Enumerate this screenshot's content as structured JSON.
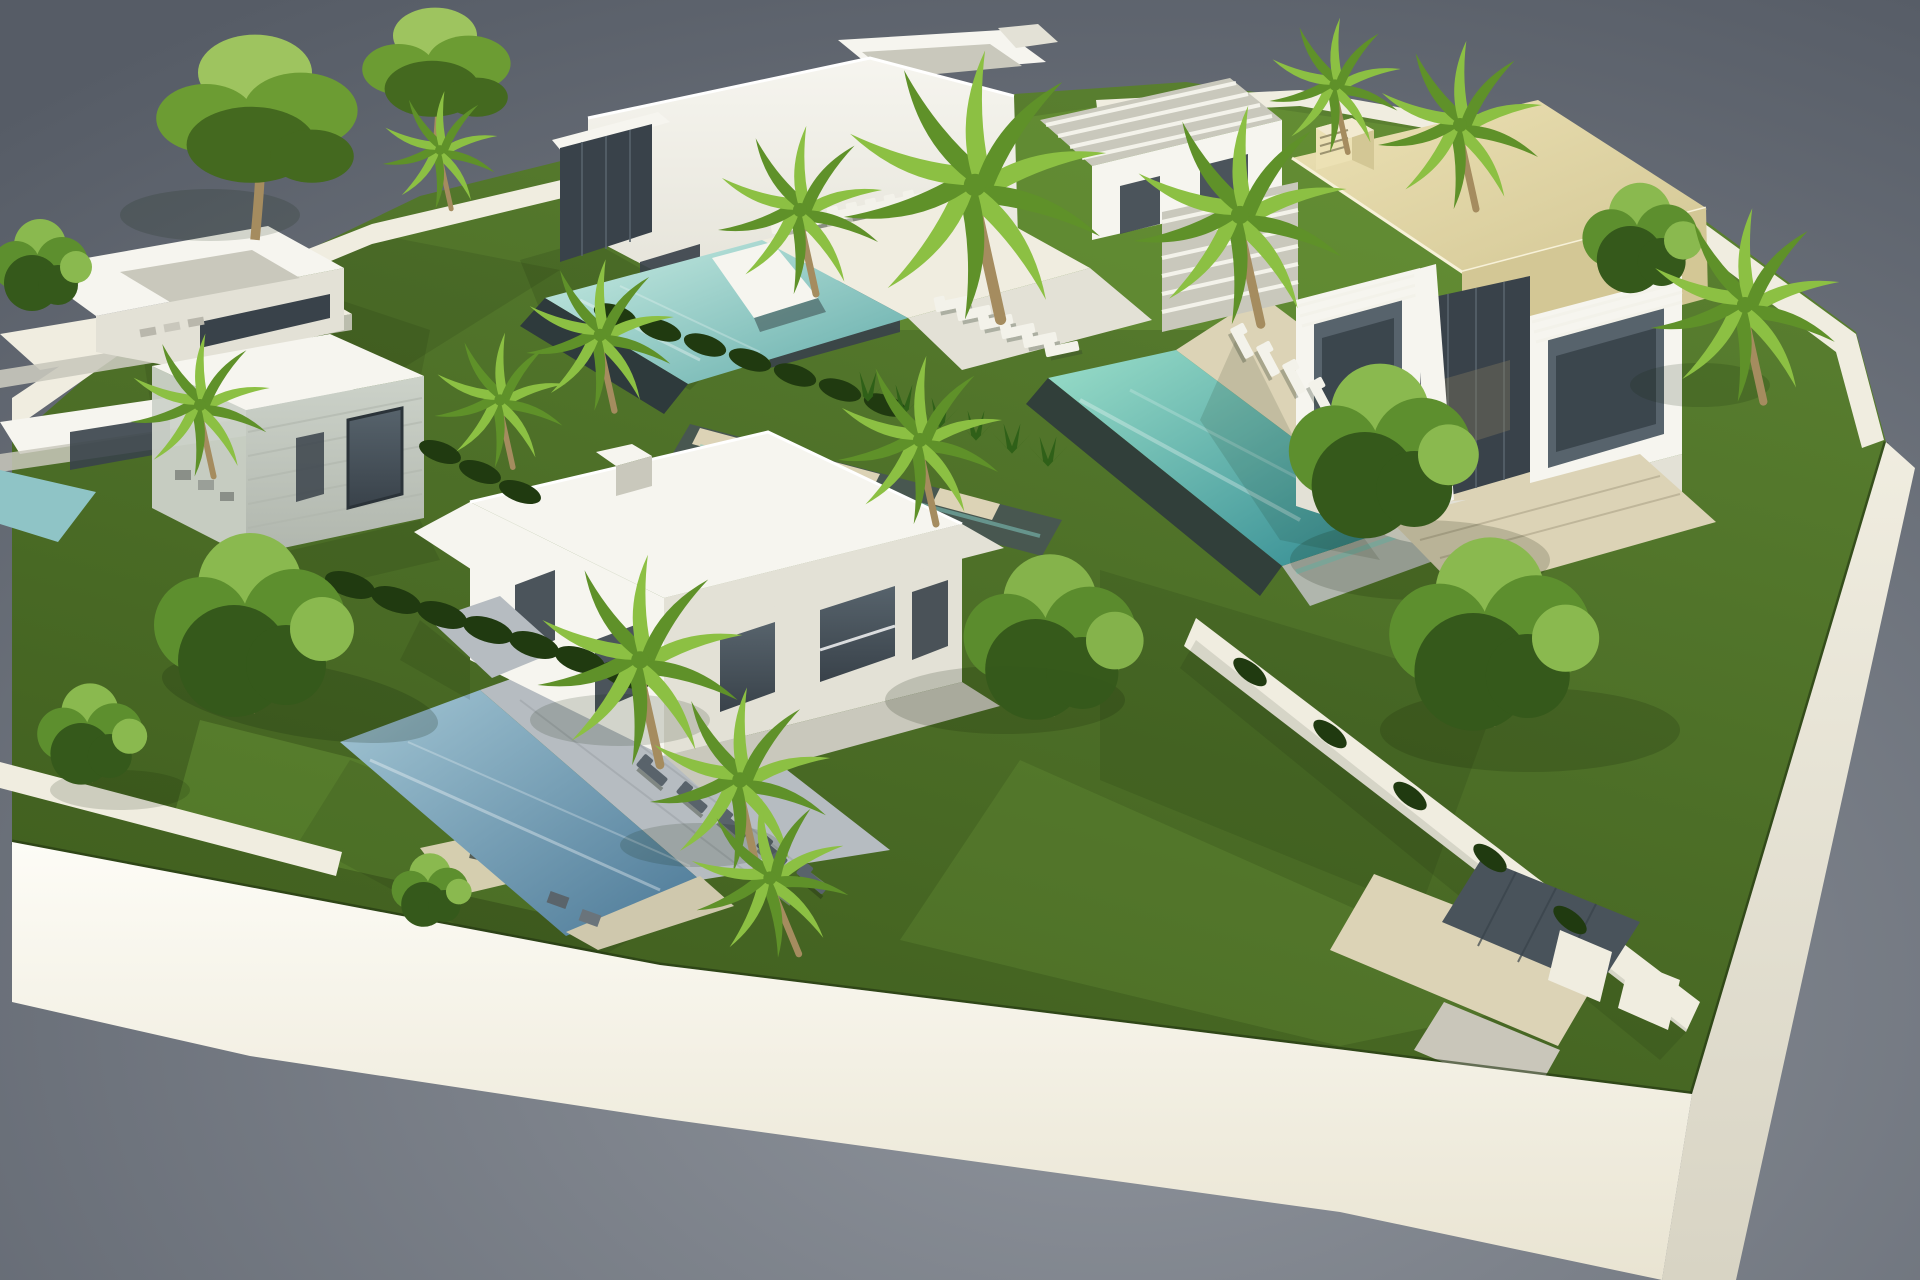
{
  "scene": {
    "description": "Aerial 3D architectural rendering of a walled luxury villa development: five modern white villas with private pools, green lawns, palm trees and a bright white perimeter wall, floating on a grey studio background.",
    "type": "architectural-visualization",
    "villas": [
      "left flat-roof white villa",
      "stone-clad guest villa",
      "top-centre villa with infinity pool and roof terrace",
      "beige-roof villa with long pool",
      "bottom-centre two-storey villa with lap pool"
    ],
    "pools": [
      "infinity pool (top centre)",
      "long pool (right)",
      "lap pool (bottom centre)",
      "corner plunge pool (left edge)"
    ],
    "tree_count": 25,
    "sun_lounger_count": 27
  },
  "palette": {
    "bg_center": "#90959d",
    "bg_edge": "#565c66",
    "wall_top": "#fdfcf6",
    "wall_bottom": "#e9e4d2",
    "wall_side_top": "#f0ede0",
    "wall_side_bottom": "#d8d4c4",
    "lawn_a": "#5a8030",
    "lawn_b": "#3f5d1e",
    "lawn_light": "#6f9d3a",
    "shadow": "rgba(15,30,8,0.38)",
    "pool_top_pale": "#c9ece3",
    "pool_top_deep": "#63acaa",
    "pool_right_pale": "#9adec9",
    "pool_right_deep": "#2f8890",
    "pool_bottom_pale": "#a3c6d4",
    "pool_bottom_deep": "#4c7997",
    "pool_left": "#8fc4c6",
    "pool_edge_dark": "#2e3a3c",
    "stone_water": "#485750",
    "roof_beige_light": "#ece1b4",
    "roof_beige_dark": "#d3c795",
    "villa_light": "#f6f5ef",
    "villa_shade": "#e3e1d6",
    "villa_dark": "#c9c8bc",
    "glass_light": "#57636c",
    "glass_dark": "#39424a",
    "stone_light": "#ccd2c9",
    "stone_dark": "#b0b6ad",
    "deck_beige": "#dcd3b6",
    "paving_gray": "#b6bcc1",
    "paver_dark": "#49535b",
    "hedge": "#203a10",
    "agave": "#2f6018",
    "palm_bright": "#8cc043",
    "palm_deep": "#5f9129",
    "trunk_brown": "#a58c5f",
    "pine_green": "#6c9c33",
    "pine_dark": "#44691f",
    "pine_light": "#9ec45f",
    "leafy_green": "#5d8f2e",
    "leafy_dark": "#35591b",
    "leafy_light": "#8ab94f",
    "lounger_white": "#f3f2ea",
    "lounger_dark": "#59636b"
  }
}
